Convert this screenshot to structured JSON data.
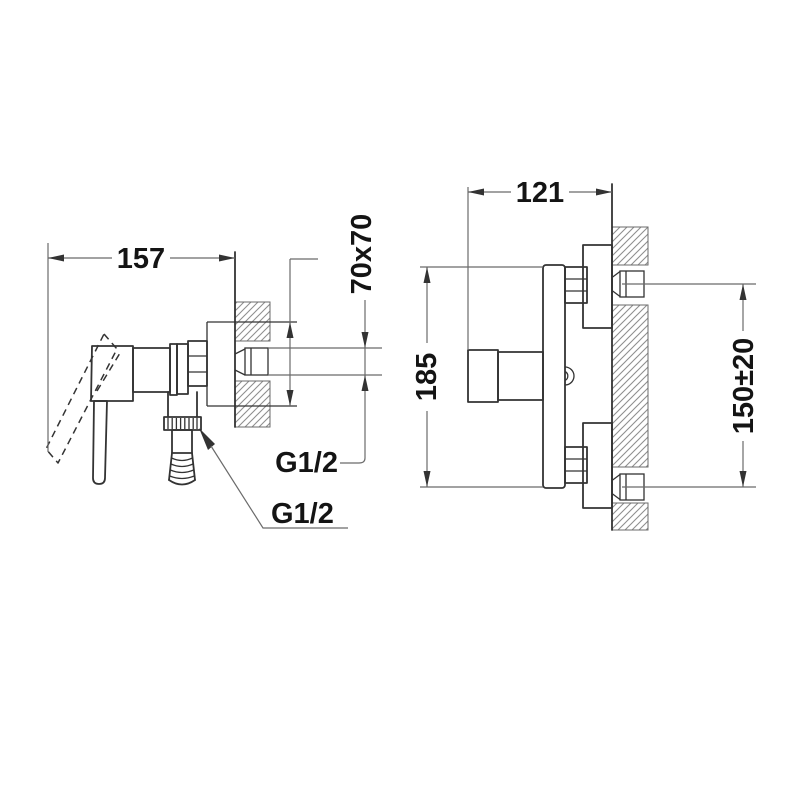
{
  "drawing_title": "Shower mixer installation dimension drawing",
  "views": {
    "side": {
      "dim_projection": "157",
      "dim_plate": "70x70",
      "dim_inlet_thread": "G1/2",
      "dim_outlet_thread": "G1/2"
    },
    "front": {
      "dim_depth": "121",
      "dim_height": "185",
      "dim_connection_spacing": "150±20"
    }
  },
  "colors": {
    "background": "#ffffff",
    "object_line": "#333333",
    "dim_line": "#6b6b6b",
    "hatch": "#8f8f8f",
    "text": "#141414"
  }
}
